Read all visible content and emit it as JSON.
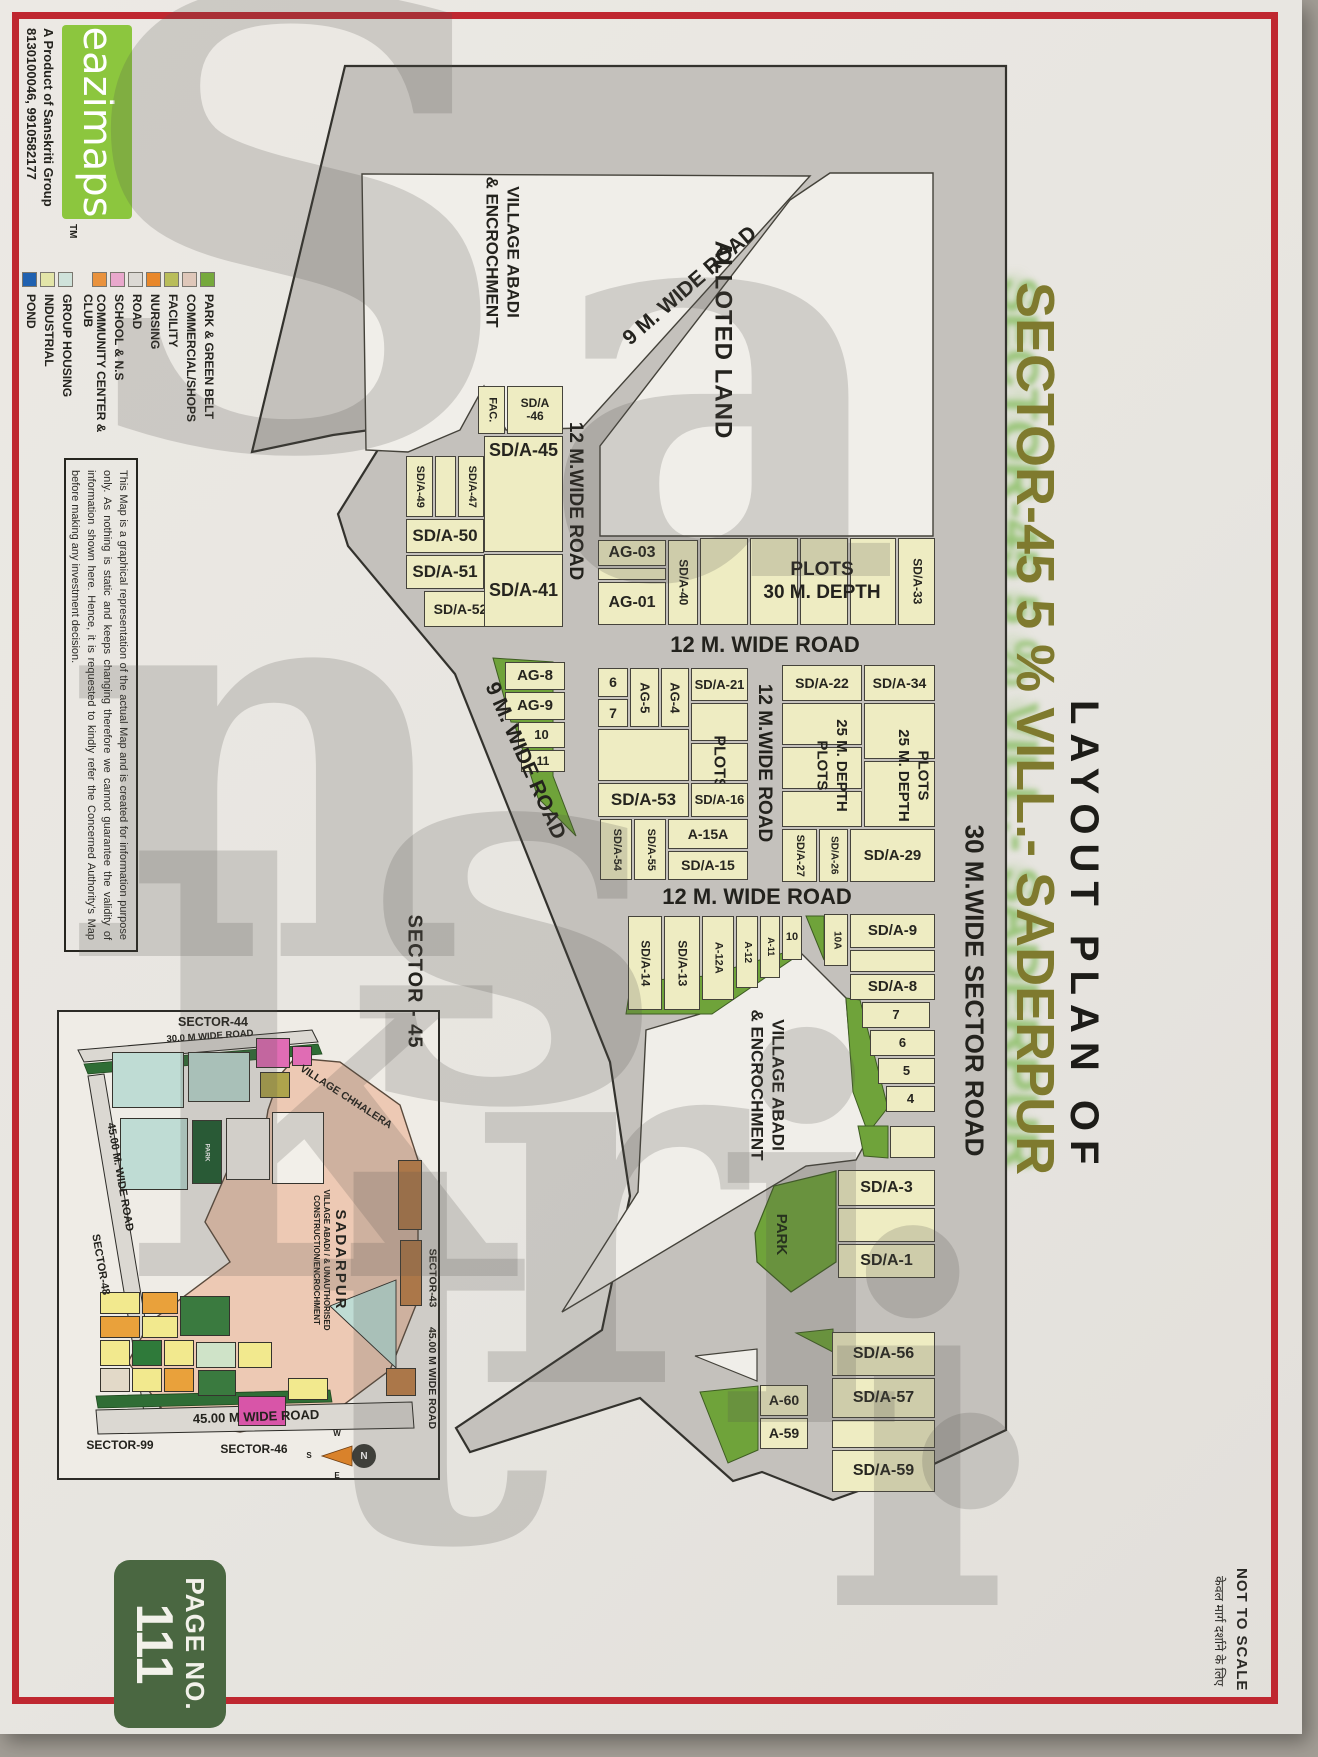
{
  "page": {
    "number_label": "PAGE NO.",
    "number": "111",
    "not_to_scale": "NOT TO SCALE",
    "not_to_scale_hindi": "केवल मार्ग दर्शाने के लिए"
  },
  "title": {
    "line1": "LAYOUT PLAN OF",
    "line2": "SECTOR-45 5 % VILL.- SADERPUR",
    "accent_color": "#7f7a2e"
  },
  "brand": {
    "logo": "eazimaps",
    "tm": "TM",
    "tagline1": "A Product of Sanskriti Group",
    "tagline2": "8130100046, 9910582177",
    "logo_bg": "#8cc63e"
  },
  "legend": {
    "items": [
      {
        "label": "PARK & GREEN BELT",
        "color": "#76a93c"
      },
      {
        "label": "COMMERCIAL/SHOPS",
        "color": "#dfc7b9"
      },
      {
        "label": "FACILITY",
        "color": "#b9bd5a"
      },
      {
        "label": "NURSING",
        "color": "#e8872a"
      },
      {
        "label": "ROAD",
        "color": "#dcd9d4"
      },
      {
        "label": "SCHOOL & N.S",
        "color": "#e9a8cc"
      },
      {
        "label": "COMMUNITY CENTER & CLUB",
        "color": "#e9923d"
      },
      {
        "label": "GROUP HOUSING",
        "color": "#cfe2da"
      },
      {
        "label": "INDUSTRIAL",
        "color": "#e3e5a8"
      },
      {
        "label": "POND",
        "color": "#2061b0"
      }
    ]
  },
  "disclaimer": "This Map is a graphical representation of the actual Map and is created for information purpose only. As nothing is static and keeps changing therefore we cannot guarantee the validity of information shown here. Hence, it is requested to kindly refer the Concerned Authority's Map before making any investment decision.",
  "watermark": {
    "letters": [
      "S",
      "a",
      "n",
      "s",
      "k",
      "r",
      "i",
      "t",
      "i",
      "."
    ]
  },
  "map": {
    "village_line1": "VILLAGE ABADI",
    "village_line2": "& ENCROCHMENT",
    "alloted": "ALLOTED LAND",
    "roads": {
      "r9": "9 M. WIDE ROAD",
      "r12": "12 M.WIDE ROAD",
      "r12b": "12 M. WIDE ROAD",
      "r30": "30 M.WIDE SECTOR ROAD"
    },
    "plots": {
      "fac": "FAC.",
      "sd46": "SD/A -46",
      "sd45": "SD/A-45",
      "sd49": "SD/A-49",
      "sd47": "SD/A-47",
      "sd50": "SD/A-50",
      "sd51": "SD/A-51",
      "sd52": "SD/A-52",
      "sd41": "SD/A-41",
      "ag03": "AG-03",
      "ag01": "AG-01",
      "sd40": "SD/A-40",
      "sd33": "SD/A-33",
      "plots30_l1": "PLOTS",
      "plots30_l2": "30 M. DEPTH",
      "n6": "6",
      "n7": "7",
      "ag5": "AG-5",
      "ag4": "AG-4",
      "sd21": "SD/A-21",
      "plots_word": "PLOTS",
      "sd53": "SD/A-53",
      "sd16": "SD/A-16",
      "sd54": "SD/A-54",
      "sd55": "SD/A-55",
      "a15a": "A-15A",
      "sd15": "SD/A-15",
      "sd22": "SD/A-22",
      "plots25_l1": "PLOTS",
      "plots25_l2": "25 M. DEPTH",
      "sd34": "SD/A-34",
      "sd27": "SD/A-27",
      "sd26": "SD/A-26",
      "sd29": "SD/A-29",
      "ag8": "AG-8",
      "ag9": "AG-9",
      "n10": "10",
      "n11": "11",
      "sd14": "SD/A-14",
      "sd13": "SD/A-13",
      "a12a": "A-12A",
      "a12": "A-12",
      "a11": "A-11",
      "n10a": "10A",
      "sd9": "SD/A-9",
      "sd8": "SD/A-8",
      "n5": "5",
      "n4": "4",
      "sd3": "SD/A-3",
      "park": "PARK",
      "sd1": "SD/A-1",
      "sd56": "SD/A-56",
      "sd57": "SD/A-57",
      "sd59": "SD/A-59",
      "a60": "A-60",
      "a59": "A-59"
    }
  },
  "inset": {
    "title": "SECTOR - 45",
    "sector44": "SECTOR-44",
    "sector43": "SECTOR-43",
    "sector46": "SECTOR-46",
    "sector99": "SECTOR-99",
    "sector48": "SECTOR-48",
    "road30": "30.0 M WIDE ROAD",
    "road45_left": "45.00 M. WIDE ROAD",
    "road45_bottom": "45.00 M WIDE ROAD",
    "road45_right": "45.00 M WIDE ROAD",
    "village_chhalera": "VILLAGE CHHALERA",
    "sadarpur": "SADARPUR",
    "sadarpur_sub1": "VILLAGE ABADI / & UNAUTHORISED",
    "sadarpur_sub2": "CONSTRUCTION/ENCROCHMENT",
    "park": "PARK",
    "compass_n": "N",
    "compass_w": "W",
    "compass_s": "S",
    "compass_e": "E"
  }
}
